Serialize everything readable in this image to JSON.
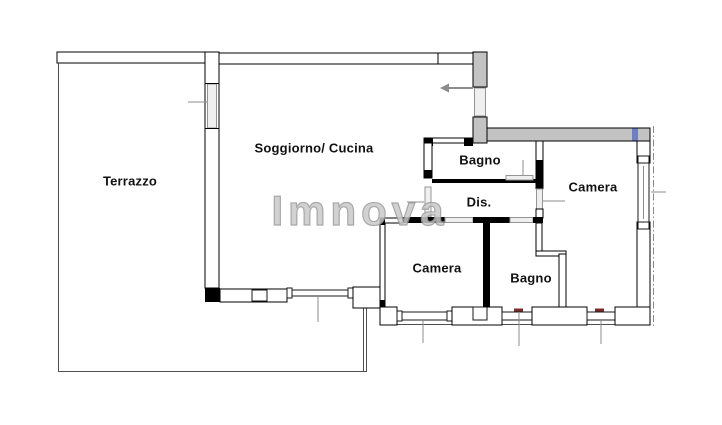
{
  "watermark": {
    "text": "Imnova"
  },
  "rooms": {
    "terrazzo": {
      "label": "Terrazzo"
    },
    "soggiorno_cucina": {
      "label": "Soggiorno/ Cucina"
    },
    "bagno_top": {
      "label": "Bagno"
    },
    "disimpegno": {
      "label": "Dis."
    },
    "camera_right": {
      "label": "Camera"
    },
    "camera_bottom": {
      "label": "Camera"
    },
    "bagno_bottom": {
      "label": "Bagno"
    }
  },
  "icons": {
    "entry_arrow": "left-arrow"
  },
  "colors": {
    "wall_fill": "#ffffff",
    "wall_outline": "#000000",
    "loadbearing_gray": "#c3c3c3",
    "watermark_gray": "#c9c9c9",
    "dimension_gray": "#8c8c8c",
    "accent_blue": "#6f7fc0",
    "accent_red": "#7b2b2b"
  }
}
